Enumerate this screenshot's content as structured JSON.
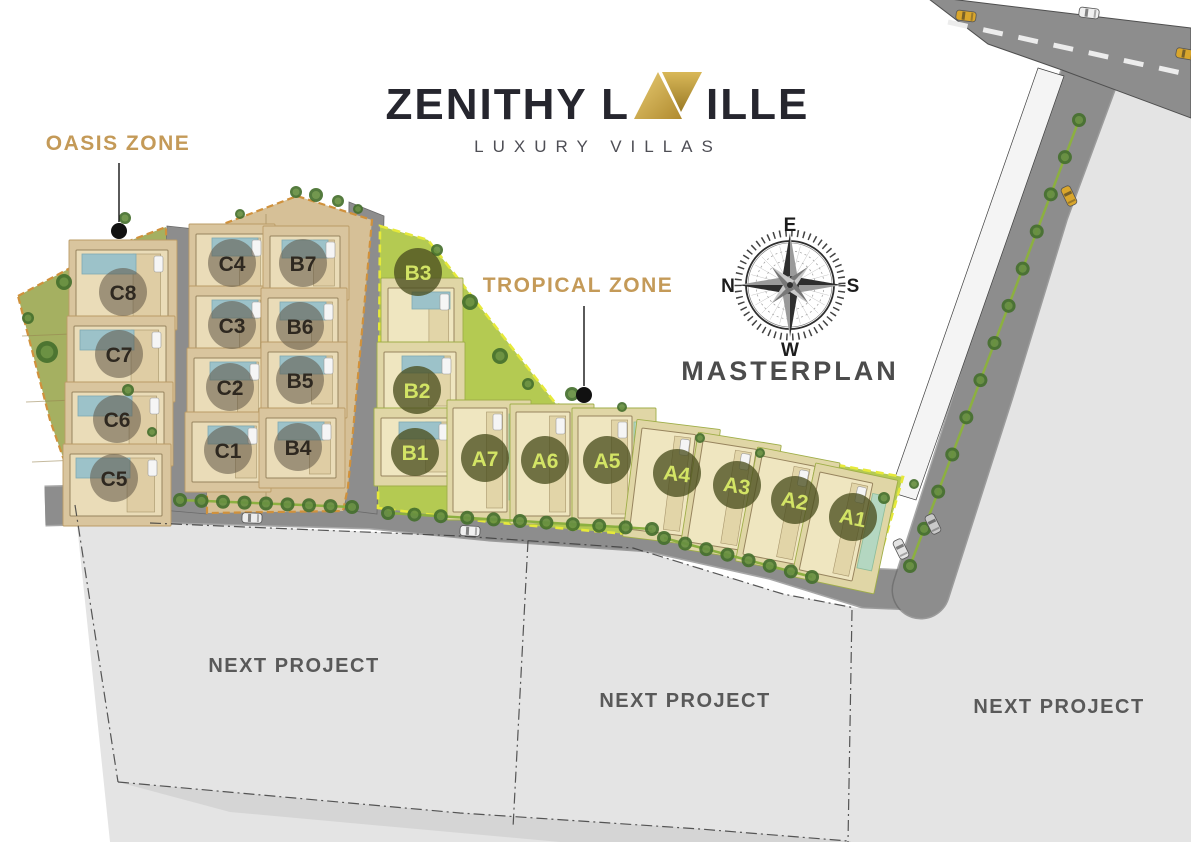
{
  "title": {
    "name": "ZENITHY LAVILLE",
    "name_prefix": "ZENITHY L",
    "monogram": "AV",
    "name_suffix": "ILLE",
    "subtitle": "LUXURY VILLAS"
  },
  "map": {
    "masterplan_label": "MASTERPLAN",
    "compass": {
      "n": "N",
      "e": "E",
      "s": "S",
      "w": "W"
    },
    "zone_labels": [
      {
        "id": "oasis-zone",
        "label": "OASIS ZONE"
      },
      {
        "id": "tropical-zone",
        "label": "TROPICAL ZONE"
      }
    ],
    "next_project_labels": [
      "NEXT PROJECT",
      "NEXT PROJECT",
      "NEXT PROJECT"
    ],
    "villas": [
      {
        "label": "C8",
        "zone": "oasis"
      },
      {
        "label": "C7",
        "zone": "oasis"
      },
      {
        "label": "C6",
        "zone": "oasis"
      },
      {
        "label": "C5",
        "zone": "oasis"
      },
      {
        "label": "C4",
        "zone": "oasis"
      },
      {
        "label": "C3",
        "zone": "oasis"
      },
      {
        "label": "C2",
        "zone": "oasis"
      },
      {
        "label": "C1",
        "zone": "oasis"
      },
      {
        "label": "B7",
        "zone": "oasis"
      },
      {
        "label": "B6",
        "zone": "oasis"
      },
      {
        "label": "B5",
        "zone": "oasis"
      },
      {
        "label": "B4",
        "zone": "oasis"
      },
      {
        "label": "B3",
        "zone": "tropical"
      },
      {
        "label": "B2",
        "zone": "tropical"
      },
      {
        "label": "B1",
        "zone": "tropical"
      },
      {
        "label": "A7",
        "zone": "tropical"
      },
      {
        "label": "A6",
        "zone": "tropical"
      },
      {
        "label": "A5",
        "zone": "tropical"
      },
      {
        "label": "A4",
        "zone": "tropical"
      },
      {
        "label": "A3",
        "zone": "tropical"
      },
      {
        "label": "A2",
        "zone": "tropical"
      },
      {
        "label": "A1",
        "zone": "tropical"
      }
    ],
    "colors": {
      "zone_label_text": "#c49a58",
      "logo_gold": "#c9a445",
      "tropical_green": "#b4ca52",
      "oasis_green": "#a5b061",
      "block_tan": "#d6c097",
      "road_gray": "#8d8d8d",
      "future_parcel_gray": "#e4e4e4",
      "pool_blue": "#9cc2c9",
      "pool_green": "#b4d7c1"
    }
  }
}
